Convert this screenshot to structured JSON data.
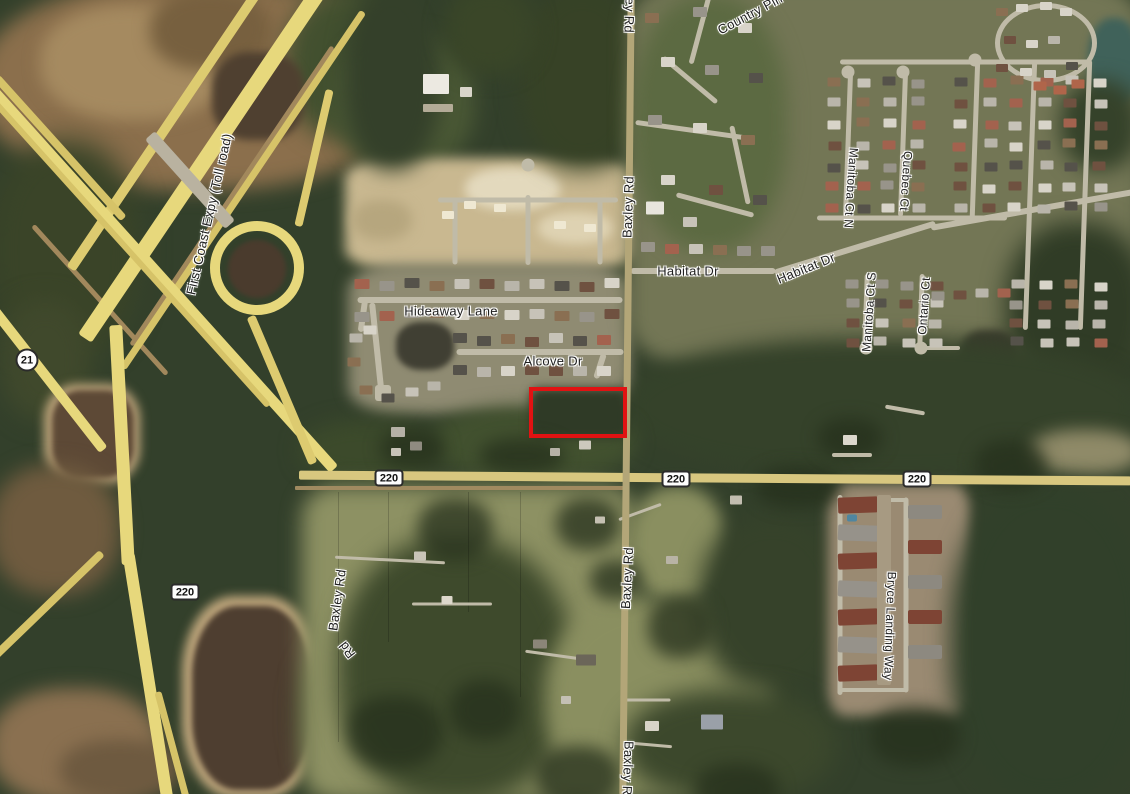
{
  "map": {
    "type": "satellite-imagery",
    "label_text_color": "#1f1f1f",
    "label_halo_color": "#ffffff",
    "highway_color": "#e7d87c",
    "parcel_outline": {
      "x": 529,
      "y": 387,
      "width": 98,
      "height": 51,
      "border_color": "#e11212",
      "border_width": 4
    },
    "route_shields": [
      {
        "id": "sr-21",
        "shape": "circle",
        "text": "21",
        "x": 27,
        "y": 360
      },
      {
        "id": "sr-220-west",
        "shape": "rect",
        "text": "220",
        "x": 389,
        "y": 478
      },
      {
        "id": "sr-220-mid",
        "shape": "rect",
        "text": "220",
        "x": 676,
        "y": 479
      },
      {
        "id": "sr-220-east",
        "shape": "rect",
        "text": "220",
        "x": 917,
        "y": 479
      },
      {
        "id": "sr-220-southwest",
        "shape": "rect",
        "text": "220",
        "x": 185,
        "y": 592
      }
    ],
    "road_labels": [
      {
        "id": "first-coast-expy",
        "text": "First Coast Expy (Toll road)",
        "x": 209,
        "y": 214,
        "rot": -77,
        "size": 13
      },
      {
        "id": "country-pin",
        "text": "Country Pin",
        "x": 750,
        "y": 14,
        "rot": -28,
        "size": 13
      },
      {
        "id": "baxley-rd-top",
        "text": "Baxley Rd",
        "x": 630,
        "y": 2,
        "rot": 92,
        "size": 13
      },
      {
        "id": "baxley-rd-upper",
        "text": "Baxley Rd",
        "x": 628,
        "y": 207,
        "rot": -88,
        "size": 13
      },
      {
        "id": "habitat-dr-west",
        "text": "Habitat Dr",
        "x": 688,
        "y": 271,
        "rot": 0,
        "size": 13
      },
      {
        "id": "habitat-dr-east",
        "text": "Habitat Dr",
        "x": 806,
        "y": 268,
        "rot": -22,
        "size": 13
      },
      {
        "id": "hideaway-lane",
        "text": "Hideaway Lane",
        "x": 451,
        "y": 311,
        "rot": 0,
        "size": 13
      },
      {
        "id": "alcove-dr",
        "text": "Alcove Dr",
        "x": 553,
        "y": 361,
        "rot": 0,
        "size": 13
      },
      {
        "id": "manitoba-ct-n",
        "text": "Manitoba Ct N",
        "x": 851,
        "y": 188,
        "rot": 94,
        "size": 12
      },
      {
        "id": "quebec-ct",
        "text": "Quebec Ct",
        "x": 906,
        "y": 181,
        "rot": 94,
        "size": 12
      },
      {
        "id": "manitoba-ct-s",
        "text": "Manitoba Ct S",
        "x": 869,
        "y": 312,
        "rot": -86,
        "size": 12
      },
      {
        "id": "ontario-ct",
        "text": "Ontario Ct",
        "x": 924,
        "y": 306,
        "rot": -86,
        "size": 12
      },
      {
        "id": "baxley-rd-mid",
        "text": "Baxley Rd",
        "x": 627,
        "y": 578,
        "rot": -87,
        "size": 13
      },
      {
        "id": "baxley-rd-diagonal",
        "text": "Baxley Rd",
        "x": 337,
        "y": 600,
        "rot": -82,
        "size": 13
      },
      {
        "id": "baxley-rd-fragment",
        "text": "Rd",
        "x": 347,
        "y": 650,
        "rot": -128,
        "size": 13
      },
      {
        "id": "bryce-landing-way",
        "text": "Bryce Landing Way",
        "x": 890,
        "y": 626,
        "rot": 92,
        "size": 12
      },
      {
        "id": "baxley-rd-bottom",
        "text": "Baxley Rd",
        "x": 628,
        "y": 772,
        "rot": 92,
        "size": 13
      }
    ]
  }
}
